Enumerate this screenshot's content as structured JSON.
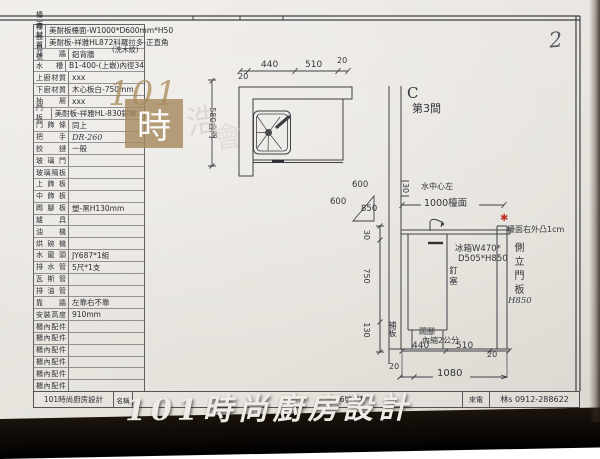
{
  "page": {
    "number": "2"
  },
  "watermark": {
    "brand_101": "101",
    "brand_shi": "時",
    "ghost_1": "浩",
    "ghost_2": "會",
    "bottom": "101時尚廚房設計"
  },
  "spec_table": {
    "color_note": "(洗木紋)",
    "rows": [
      {
        "label": "檯面材質",
        "value": "美耐板檯面-W1000*D600mm*H50"
      },
      {
        "label": "檯面色號",
        "value": "美耐板-祥雅HL872科羅拉多-正直角"
      },
      {
        "label": "背牆",
        "value": "鋁背牆"
      },
      {
        "label": "水槽",
        "value": "B1-400-(上嵌)內徑34"
      },
      {
        "label": "上廚材質",
        "value": "xxx"
      },
      {
        "label": "下廚材質",
        "value": "木心板白-750mm"
      },
      {
        "label": "抽屜",
        "value": "xxx"
      },
      {
        "label": "門板",
        "value": "美耐板-祥雅HL-830銀櫸木"
      },
      {
        "label": "門飾條",
        "value": "同上"
      },
      {
        "label": "把手",
        "value": "DR-260",
        "handwritten": true
      },
      {
        "label": "鉸鏈",
        "value": "一般"
      },
      {
        "label": "玻璃門",
        "value": ""
      },
      {
        "label": "玻璃隔板",
        "value": ""
      },
      {
        "label": "上飾板",
        "value": ""
      },
      {
        "label": "中飾板",
        "value": ""
      },
      {
        "label": "踢腳板",
        "value": "塑-黑H130mm"
      },
      {
        "label": "爐具",
        "value": ""
      },
      {
        "label": "油機",
        "value": ""
      },
      {
        "label": "烘碗機",
        "value": ""
      },
      {
        "label": "水龍頭",
        "value": "JY687*1組"
      },
      {
        "label": "排水管",
        "value": "5尺*1支"
      },
      {
        "label": "瓦斯管",
        "value": ""
      },
      {
        "label": "排油管",
        "value": ""
      },
      {
        "label": "靠牆",
        "value": "左靠右不靠"
      },
      {
        "label": "安裝高度",
        "value": "910mm"
      },
      {
        "label": "櫃內配件",
        "value": ""
      },
      {
        "label": "櫃內配件",
        "value": ""
      },
      {
        "label": "櫃內配件",
        "value": ""
      },
      {
        "label": "櫃內配件",
        "value": ""
      },
      {
        "label": "櫃內配件",
        "value": ""
      },
      {
        "label": "櫃內配件",
        "value": ""
      }
    ]
  },
  "footer": {
    "company": "101時尚廚房設計",
    "name_label": "名稱",
    "address": "16號4樓",
    "phone_label": "來電",
    "phone": "林s 0912-288622"
  },
  "drawing": {
    "plan": {
      "dim_20_left": "20",
      "dim_440": "440",
      "dim_510": "510",
      "dim_20_right": "20",
      "door_dim": "580合門"
    },
    "corner_triangle": {
      "a": "600",
      "b": "600",
      "c": "850"
    },
    "elevation": {
      "room_letter": "C",
      "room_name": "第3間",
      "offset_30": "30",
      "water_center": "水中心左",
      "counter_1000": "1000檯面",
      "fridge_1": "冰箱W470*",
      "fridge_2": "D505*H850",
      "nail_plug": "釘塞",
      "counter_note": "檯面右外凸1cm",
      "red_mark": "✱",
      "side_panel": "側立門板",
      "side_panel_height": "H850",
      "h_counter": "30",
      "h_cabinet": "750",
      "h_kick": "130",
      "filler": "補板",
      "kick_1": "踢腳",
      "kick_2": "內縮2公分",
      "w_440": "440",
      "w_510": "510",
      "w_20_right": "20",
      "w_20_left": "20",
      "w_total": "1080"
    }
  }
}
